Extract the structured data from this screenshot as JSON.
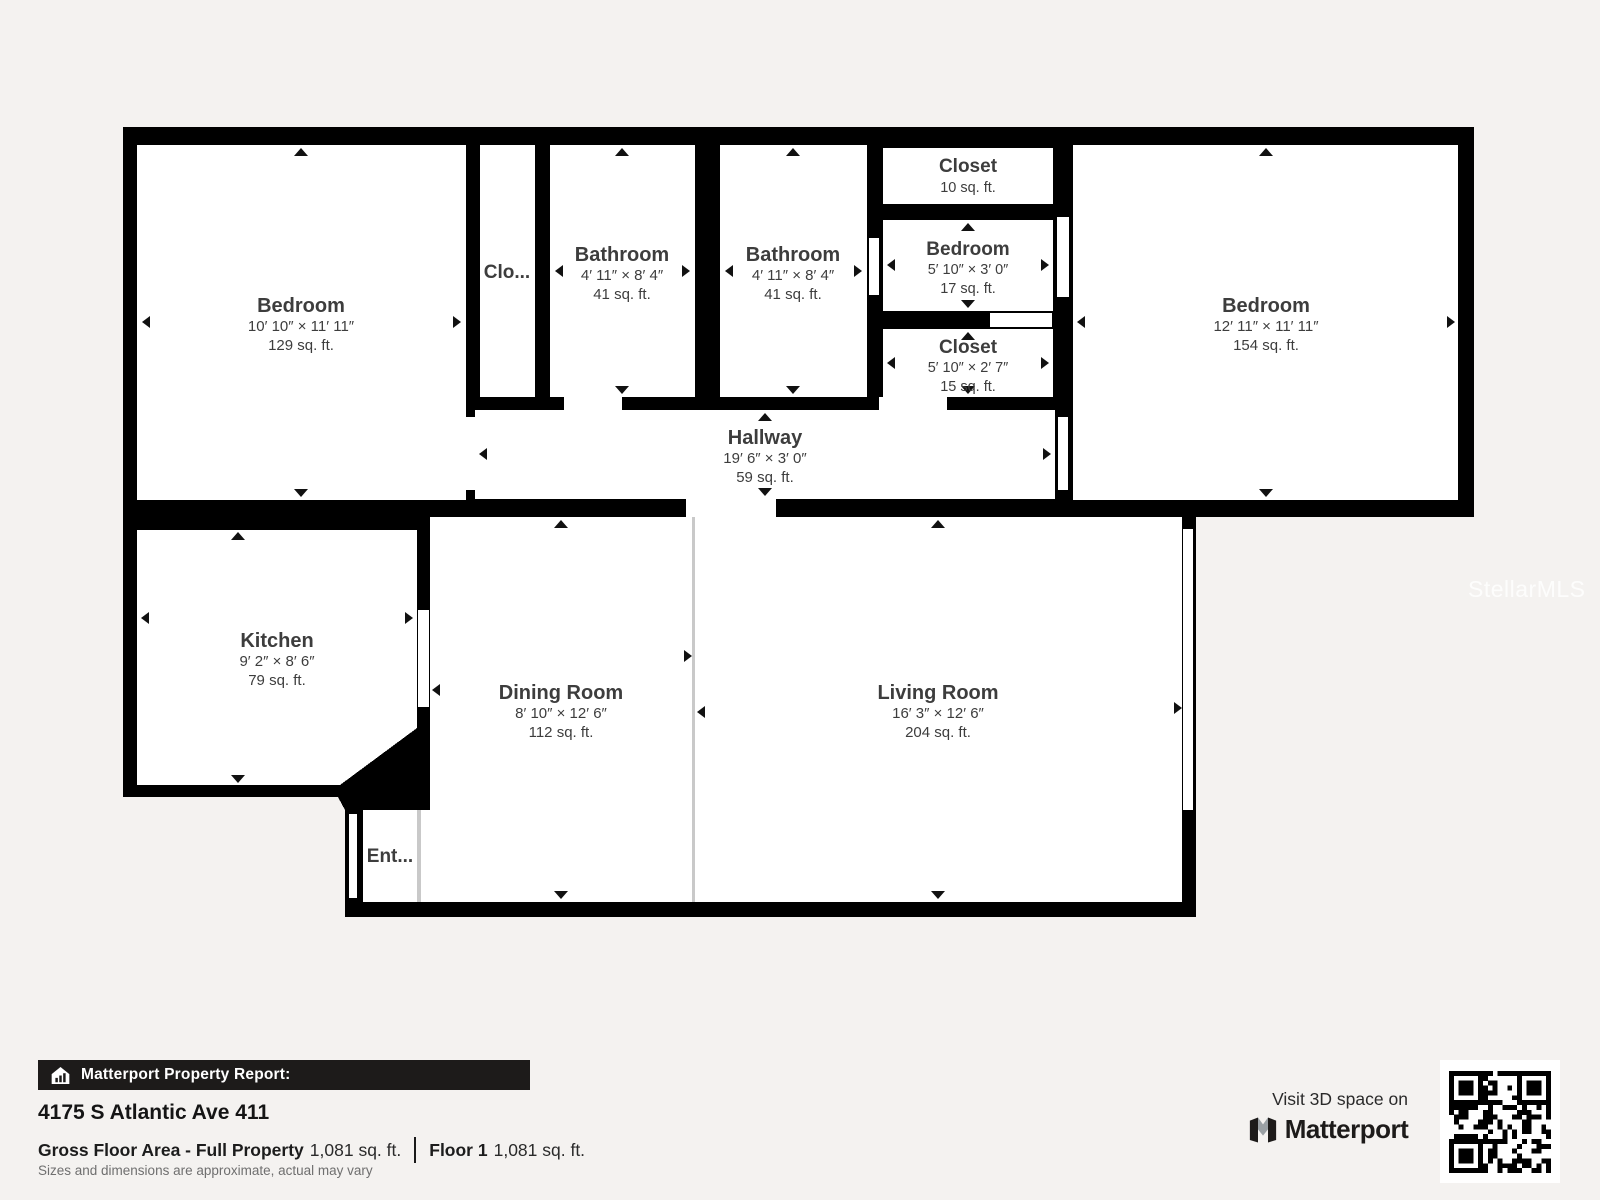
{
  "watermark": "StellarMLS",
  "floorplan": {
    "rooms": {
      "bedroomLeft": {
        "name": "Bedroom",
        "dims": "10′ 10″ × 11′ 11″",
        "area": "129 sq. ft."
      },
      "closetHall": {
        "name": "Clo..."
      },
      "bath1": {
        "name": "Bathroom",
        "dims": "4′ 11″ × 8′ 4″",
        "area": "41 sq. ft."
      },
      "bath2": {
        "name": "Bathroom",
        "dims": "4′ 11″ × 8′ 4″",
        "area": "41 sq. ft."
      },
      "closetTop": {
        "name": "Closet",
        "area": "10 sq. ft."
      },
      "bedroomSmall": {
        "name": "Bedroom",
        "dims": "5′ 10″ × 3′ 0″",
        "area": "17 sq. ft."
      },
      "closetSmall": {
        "name": "Closet",
        "dims": "5′ 10″ × 2′ 7″",
        "area": "15 sq. ft."
      },
      "bedroomRight": {
        "name": "Bedroom",
        "dims": "12′ 11″ × 11′ 11″",
        "area": "154 sq. ft."
      },
      "hallway": {
        "name": "Hallway",
        "dims": "19′ 6″ × 3′ 0″",
        "area": "59 sq. ft."
      },
      "kitchen": {
        "name": "Kitchen",
        "dims": "9′ 2″ × 8′ 6″",
        "area": "79 sq. ft."
      },
      "dining": {
        "name": "Dining Room",
        "dims": "8′ 10″ × 12′ 6″",
        "area": "112 sq. ft."
      },
      "living": {
        "name": "Living Room",
        "dims": "16′ 3″ × 12′ 6″",
        "area": "204 sq. ft."
      },
      "entry": {
        "name": "Ent..."
      }
    }
  },
  "report": {
    "bar_title": "Matterport Property Report:",
    "address": "4175 S Atlantic Ave 411",
    "gross_area_label": "Gross Floor Area - Full Property",
    "gross_area_value": "1,081 sq. ft.",
    "floor_label": "Floor 1",
    "floor_value": "1,081 sq. ft.",
    "disclaimer": "Sizes and dimensions are approximate, actual may vary"
  },
  "cta": {
    "prompt": "Visit 3D space on",
    "brand": "Matterport"
  },
  "colors": {
    "wall": "#000000",
    "room": "#ffffff",
    "label": "#3d3d3d",
    "background": "#f4f2f0",
    "bar_bg": "#1d1b1a"
  }
}
